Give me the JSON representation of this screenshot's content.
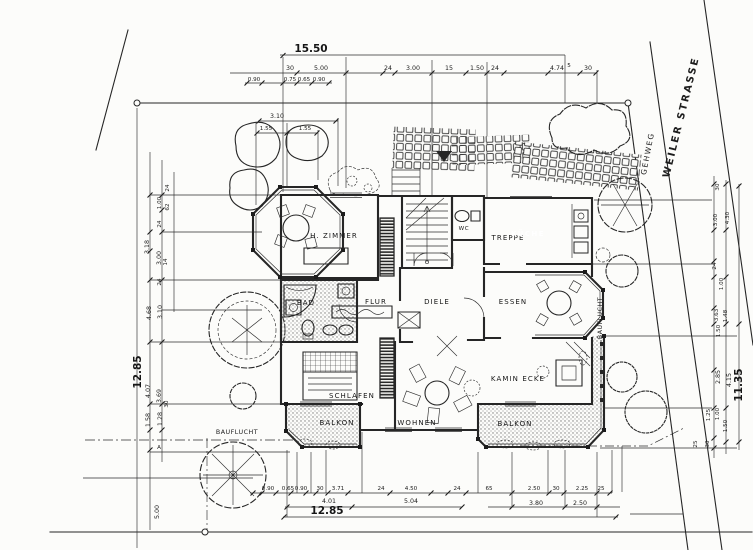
{
  "drawing": {
    "kind": "architectural site and floor plan (scanned, German)",
    "colors": {
      "ink": "#262626",
      "paper": "#fcfcfa",
      "stipple": "#7a7a7a"
    }
  },
  "site": {
    "strasse": "WEILER STRASSE",
    "gehweg": "GEHWEG",
    "bauflucht_bottom": "BAUFLUCHT",
    "bauflucht_right": "BAUFLUCHT"
  },
  "rooms": {
    "hzimmer": "H. ZIMMER",
    "treppe": "TREPPE",
    "wc": "WC",
    "kueche": "KÜCHE",
    "bad": "BAD",
    "flur": "FLUR",
    "diele": "DIELE",
    "essen": "ESSEN",
    "kamin": "KAMIN ECKE",
    "schlafen": "SCHLAFEN",
    "wohnen": "WOHNEN",
    "balkon_l": "BALKON",
    "balkon_r": "BALKON"
  },
  "dims": {
    "top": {
      "total": "15.50",
      "seg": [
        "30",
        "5.00",
        "24",
        "3.00",
        "15",
        "1.50",
        "24",
        "4.74",
        "5",
        "30"
      ],
      "sub": [
        "0.90",
        "0.75",
        "0.65",
        "0.90"
      ],
      "bay": {
        "total": "3.10",
        "a": "1.55",
        "b": "1.55"
      }
    },
    "bottom": {
      "total": "12.85",
      "row": [
        "4.01",
        "5.04",
        "3.80",
        "2.50"
      ],
      "seg": [
        "0.90",
        "0.65",
        "0.90",
        "30",
        "3.71",
        "24",
        "4.50",
        "24",
        "65",
        "2.50",
        "30",
        "2.25",
        "25"
      ]
    },
    "left": {
      "total": "12.85",
      "base": "5.00",
      "marker": "A",
      "mid": [
        "3.18",
        "4.68",
        "4.07",
        "1.58"
      ],
      "inner": [
        "3.00",
        "3.10",
        "3.69",
        "1.28"
      ],
      "small": [
        "24",
        "1.00",
        "62",
        "24",
        "14",
        "24",
        "30"
      ]
    },
    "right": {
      "total": "11.35",
      "mid": [
        "2.85",
        "4.15"
      ],
      "seg": [
        "30",
        "3.00",
        "4.30",
        "24",
        "1.00",
        "3.63",
        "1.48",
        "1.50",
        "1.25",
        "1.00",
        "1.50",
        "25",
        "30"
      ]
    }
  }
}
